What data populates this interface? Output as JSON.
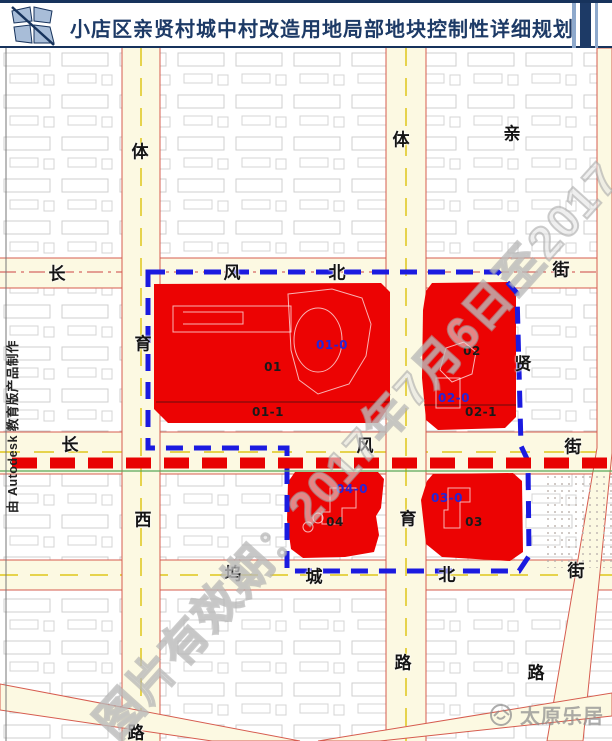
{
  "header": {
    "title": "小店区亲贤村城中村改造用地局部地块控制性详细规划"
  },
  "map": {
    "streets": {
      "chars": [
        {
          "ch": "体",
          "x": 140,
          "y": 102
        },
        {
          "ch": "育",
          "x": 143,
          "y": 294
        },
        {
          "ch": "西",
          "x": 143,
          "y": 470
        },
        {
          "ch": "路",
          "x": 136,
          "y": 683
        },
        {
          "ch": "体",
          "x": 401,
          "y": 90
        },
        {
          "ch": "育",
          "x": 408,
          "y": 469
        },
        {
          "ch": "路",
          "x": 403,
          "y": 613
        },
        {
          "ch": "亲",
          "x": 512,
          "y": 84
        },
        {
          "ch": "贤",
          "x": 523,
          "y": 314
        },
        {
          "ch": "长",
          "x": 57,
          "y": 224
        },
        {
          "ch": "风",
          "x": 232,
          "y": 223
        },
        {
          "ch": "北",
          "x": 337,
          "y": 223
        },
        {
          "ch": "街",
          "x": 561,
          "y": 220
        },
        {
          "ch": "长",
          "x": 70,
          "y": 395
        },
        {
          "ch": "风",
          "x": 365,
          "y": 396
        },
        {
          "ch": "街",
          "x": 573,
          "y": 397
        },
        {
          "ch": "坞",
          "x": 233,
          "y": 524
        },
        {
          "ch": "城",
          "x": 314,
          "y": 527
        },
        {
          "ch": "北",
          "x": 447,
          "y": 525
        },
        {
          "ch": "街",
          "x": 576,
          "y": 521
        },
        {
          "ch": "路",
          "x": 536,
          "y": 623
        }
      ]
    },
    "plots": {
      "labels": [
        {
          "text": "01-0",
          "color": "#2525d8",
          "x": 332,
          "y": 297
        },
        {
          "text": "01",
          "color": "#1a1a1a",
          "x": 273,
          "y": 319
        },
        {
          "text": "01-1",
          "color": "#1a1a1a",
          "x": 268,
          "y": 364
        },
        {
          "text": "02",
          "color": "#1a1a1a",
          "x": 472,
          "y": 303
        },
        {
          "text": "02-0",
          "color": "#2525d8",
          "x": 454,
          "y": 350
        },
        {
          "text": "02-1",
          "color": "#1a1a1a",
          "x": 481,
          "y": 364
        },
        {
          "text": "04-0",
          "color": "#2525d8",
          "x": 352,
          "y": 441
        },
        {
          "text": "04",
          "color": "#1a1a1a",
          "x": 335,
          "y": 474
        },
        {
          "text": "03-0",
          "color": "#2525d8",
          "x": 447,
          "y": 450
        },
        {
          "text": "03",
          "color": "#1a1a1a",
          "x": 474,
          "y": 474
        }
      ]
    },
    "colors": {
      "plot_fill": "#ec0303",
      "boundary_blue": "#1b1be0",
      "planning_redline": "#e80202",
      "road_fill": "#fcf9e2"
    }
  },
  "watermarks": {
    "validity": "图片有效期：2017年7月6日至2017",
    "autodesk_credit": "由 Autodesk 教育版产品制作",
    "site_name": "太原乐居"
  }
}
